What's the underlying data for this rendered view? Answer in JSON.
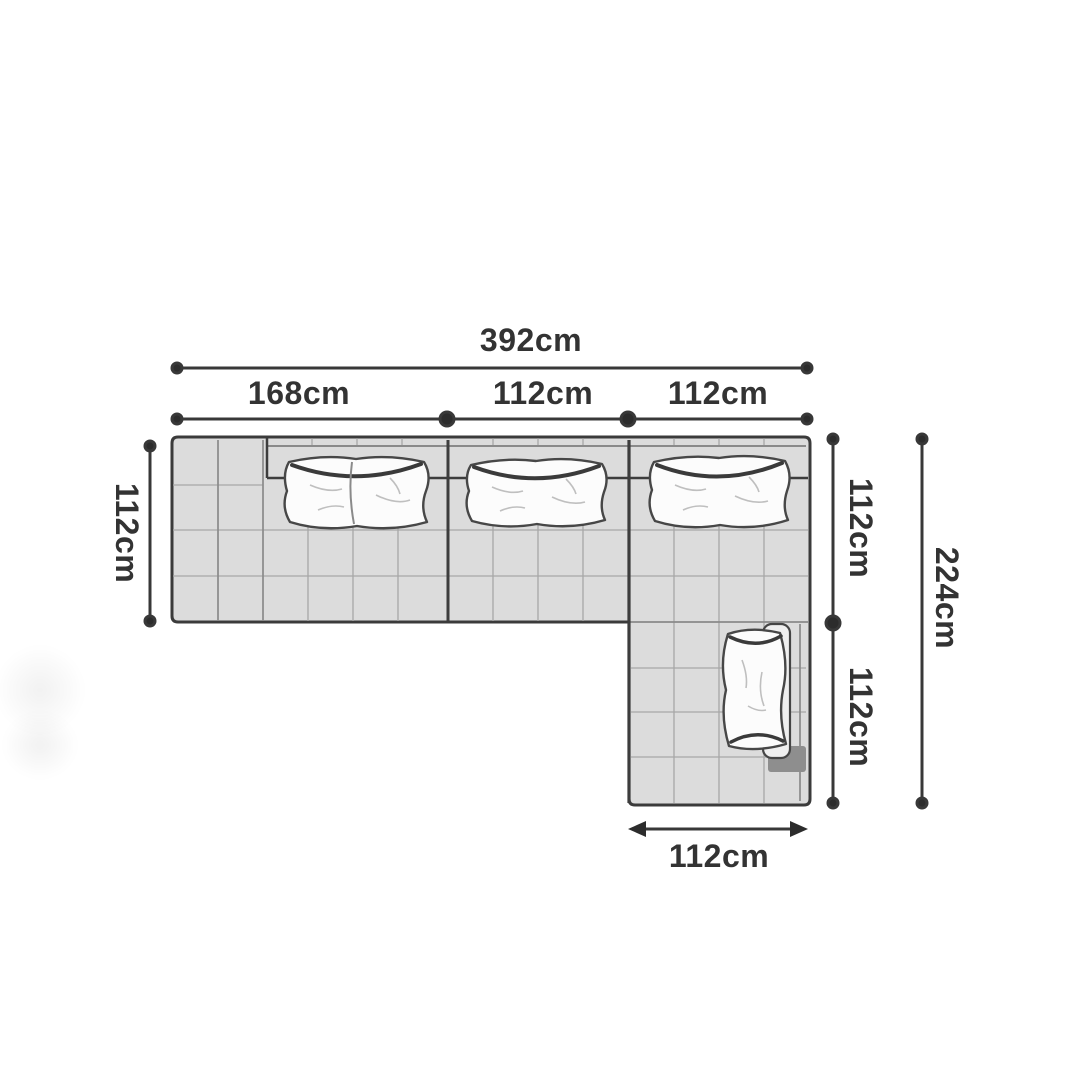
{
  "page": {
    "background": "#ffffff"
  },
  "diagram": {
    "type": "sectional-sofa-top-view-dimensions",
    "unit": "cm",
    "dimensions": {
      "top_total_label": "392cm",
      "top_segments": [
        {
          "label": "168cm"
        },
        {
          "label": "112cm"
        },
        {
          "label": "112cm"
        }
      ],
      "left_depth_label": "112cm",
      "right_segments": [
        {
          "label": "112cm"
        },
        {
          "label": "112cm"
        }
      ],
      "right_total_label": "224cm",
      "bottom_chaise_label": "112cm"
    },
    "colors": {
      "outline": "#3b3b3b",
      "sofa_fill": "#dcdcdc",
      "grid_line": "#a7a7a7",
      "pillow_fill": "#fcfcfc",
      "shadow_dark": "#8e8e8e",
      "dimension_line": "#383838",
      "label_text": "#333333"
    }
  }
}
